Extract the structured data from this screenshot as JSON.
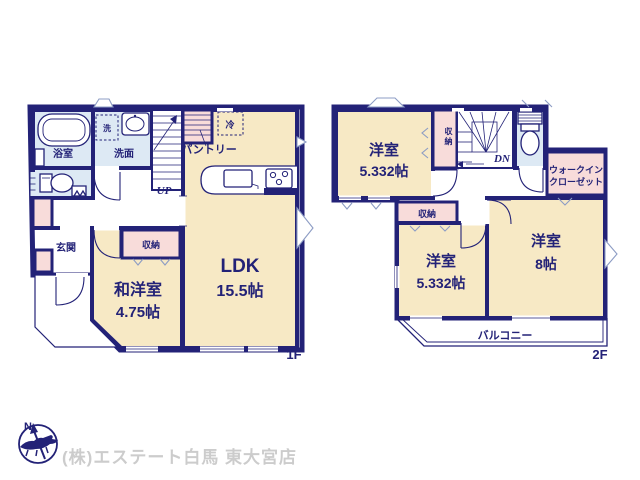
{
  "colors": {
    "wall": "#232277",
    "room_cream": "#f7e9c5",
    "room_blue": "#dde9f4",
    "room_pink": "#f8dcda",
    "window_line": "#8c9cc4",
    "watermark": "#cccccc"
  },
  "floor1": {
    "label": "1F",
    "bath": "浴室",
    "laundry": "洗",
    "washroom": "洗面",
    "up": "UP",
    "pantry": "パントリー",
    "fridge": "冷",
    "ldk": "LDK",
    "ldk_area": "15.5帖",
    "entrance": "玄関",
    "storage": "収納",
    "jw_room": "和洋室",
    "jw_area": "4.75帖"
  },
  "floor2": {
    "label": "2F",
    "room_nw": "洋室",
    "room_nw_area": "5.332帖",
    "closet_vertical": "収納",
    "dn": "DN",
    "wic_line1": "ウォークイン",
    "wic_line2": "クローゼット",
    "closet": "収納",
    "room_sw": "洋室",
    "room_sw_area": "5.332帖",
    "room_se": "洋室",
    "room_se_area": "8帖",
    "balcony": "バルコニー"
  },
  "footer": {
    "compass_n": "N",
    "company": "(株)エステート白馬 東大宮店"
  }
}
